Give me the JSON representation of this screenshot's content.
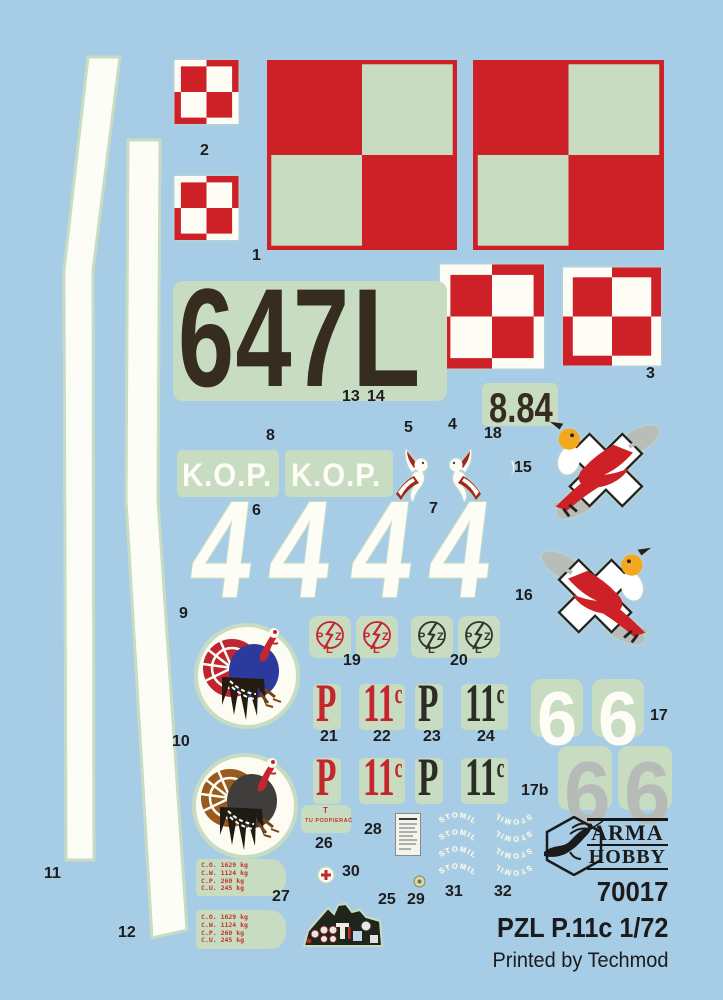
{
  "sheet_colors": {
    "background": "#a7cce6",
    "carrier_film": "#c8dcc2",
    "insignia_red": "#ce2127",
    "marking_dark": "#362c20",
    "stencil_red": "#c2342a",
    "silver_gray": "#b6bbb7"
  },
  "decals": {
    "serial": "647",
    "serial_letter": "L",
    "date": "8.84",
    "kop": "K.O.P.",
    "digit4": "4",
    "digit6": "6",
    "p": "P",
    "eleven": "11",
    "variant": "c",
    "stomil": "STOMIL",
    "support_stencil": "TU PODPIERAĆ",
    "support_mark": "T",
    "weight_lines": [
      "C.O. 1629 kg",
      "C.W. 1124 kg",
      "C.P. 260 kg",
      "C.U. 245 kg"
    ],
    "pzl": {
      "p": "P",
      "z": "Z",
      "l": "L"
    }
  },
  "labels": {
    "l1": "1",
    "l2": "2",
    "l3": "3",
    "l4": "4",
    "l5": "5",
    "l6": "6",
    "l7": "7",
    "l8": "8",
    "l9": "9",
    "l10": "10",
    "l11": "11",
    "l12": "12",
    "l13": "13",
    "l14": "14",
    "l15": "15",
    "l16": "16",
    "l17": "17",
    "l17b": "17b",
    "l18": "18",
    "l19": "19",
    "l20": "20",
    "l21": "21",
    "l22": "22",
    "l23": "23",
    "l24": "24",
    "l25": "25",
    "l26": "26",
    "l27": "27",
    "l28": "28",
    "l29": "29",
    "l30": "30",
    "l31": "31",
    "l32": "32"
  },
  "branding": {
    "brand_top": "ARMA",
    "brand_bottom": "HOBBY",
    "product_code": "70017",
    "product_name": "PZL P.11c 1/72",
    "printer": "Printed by Techmod"
  }
}
